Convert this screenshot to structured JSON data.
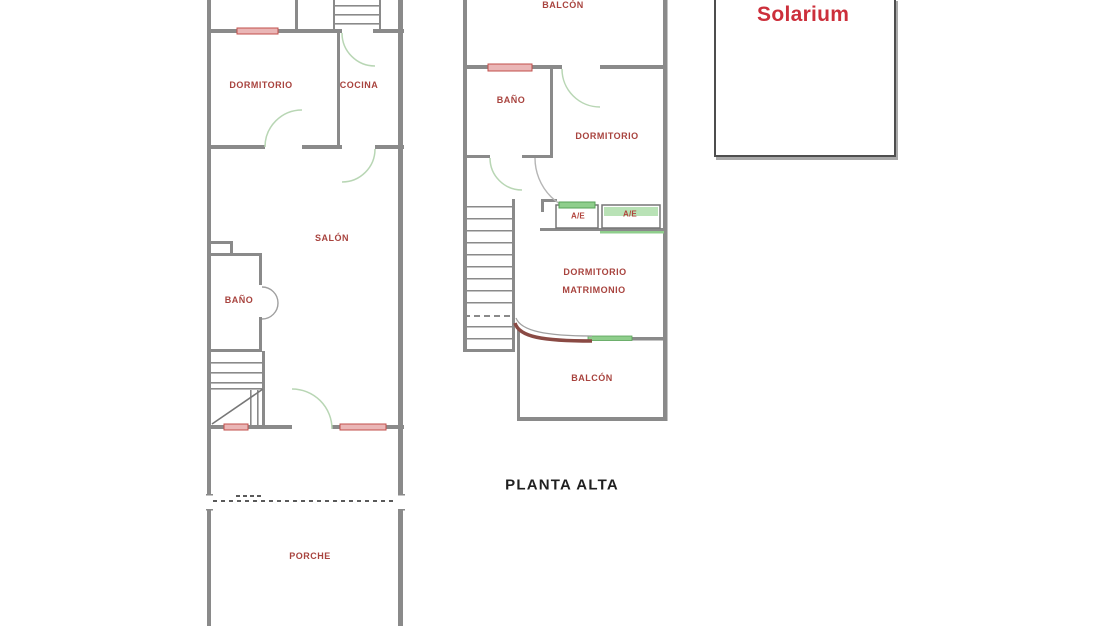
{
  "plan_title": "PLANTA ALTA",
  "ground_floor": {
    "dormitorio": "DORMITORIO",
    "cocina": "COCINA",
    "salon": "SALÓN",
    "bano": "BAÑO",
    "porche": "PORCHE"
  },
  "upper_floor": {
    "balcon_top": "BALCÓN",
    "bano": "BAÑO",
    "dormitorio": "DORMITORIO",
    "dormitorio_matrimonio_line1": "DORMITORIO",
    "dormitorio_matrimonio_line2": "MATRIMONIO",
    "ae_unit_1": "A/E",
    "ae_unit_2": "A/E",
    "balcon_bottom": "BALCÓN"
  },
  "solarium": {
    "label": "Solarium"
  },
  "colors": {
    "wall_gray": "#8a8a8a",
    "room_label_red": "#a8433e",
    "solarium_red": "#cc2f3b",
    "door_arc_green": "#b8d6b4",
    "window_pink": "#eab6b6",
    "window_red_border": "#c14f4b",
    "ae_green": "#8fce8c",
    "curved_wall_dark_red": "#8a4a44",
    "title_black": "#1f1f1f"
  }
}
